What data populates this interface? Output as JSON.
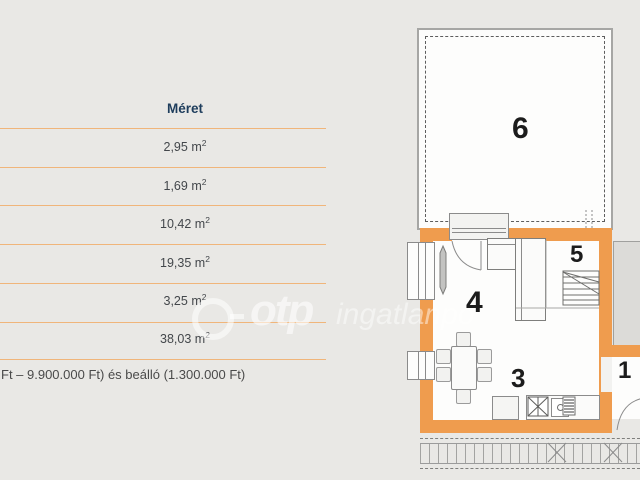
{
  "table": {
    "header": "Méret",
    "rows": [
      {
        "value": "2,95",
        "unit": "m",
        "exp": "2"
      },
      {
        "value": "1,69",
        "unit": "m",
        "exp": "2"
      },
      {
        "value": "10,42",
        "unit": "m",
        "exp": "2"
      },
      {
        "value": "19,35",
        "unit": "m",
        "exp": "2"
      },
      {
        "value": "3,25",
        "unit": "m",
        "exp": "2"
      },
      {
        "value": "38,03",
        "unit": "m",
        "exp": "2"
      }
    ],
    "footnote": "Ft – 9.900.000 Ft) és beálló (1.300.000 Ft)"
  },
  "floorplan": {
    "rooms": [
      {
        "number": "6"
      },
      {
        "number": "5"
      },
      {
        "number": "4"
      },
      {
        "number": "3"
      },
      {
        "number": "1"
      }
    ]
  },
  "watermark": {
    "brand": "otp",
    "suffix": "ingatlanpo"
  },
  "colors": {
    "background": "#E9E8E5",
    "wall_orange": "#EF9C4E",
    "table_line_orange": "#F0B57A",
    "header_navy": "#1E3D5C",
    "value_text": "#43474B"
  }
}
